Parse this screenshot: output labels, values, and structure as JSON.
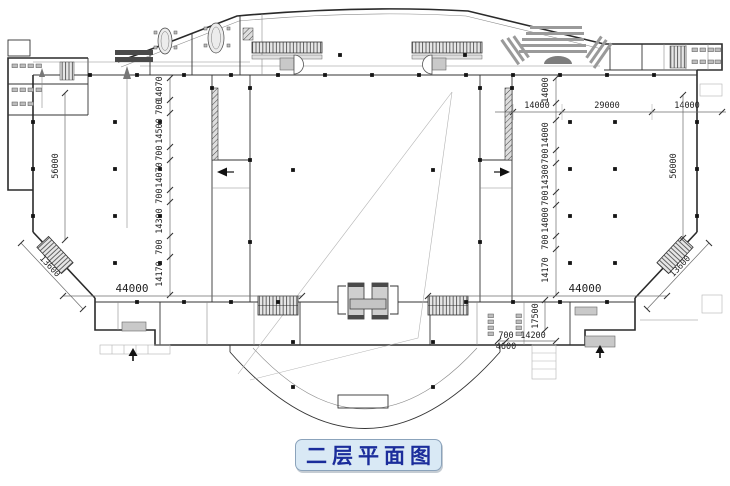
{
  "title": {
    "label": "二层平面图"
  },
  "colors": {
    "title_text": "#1b2d9b",
    "title_bg": "#d9e9f5",
    "title_border": "#8ba3bb",
    "drawing_line": "#2a2a2a",
    "dimension_text": "#222222",
    "hatch_fill": "#c9c9c9",
    "background": "#ffffff"
  },
  "dimensions": {
    "top_chain": [
      "14000",
      "29000",
      "14000"
    ],
    "left_overall_height": "56000",
    "right_overall_height": "56000",
    "left_diagonal_width": "13600",
    "right_diagonal_width": "13600",
    "left_bottom_width": "44000",
    "right_bottom_width": "44000",
    "left_bay_chain": [
      "14070",
      "700",
      "14500",
      "700",
      "14070",
      "700",
      "14300",
      "700",
      "14170"
    ],
    "right_bay_chain": [
      "14000",
      "14000",
      "700",
      "14300",
      "700",
      "14000",
      "700",
      "14170"
    ],
    "lobby_depth": "17500",
    "lobby_chain": [
      "700",
      "14200"
    ],
    "entry_width": "4600"
  }
}
